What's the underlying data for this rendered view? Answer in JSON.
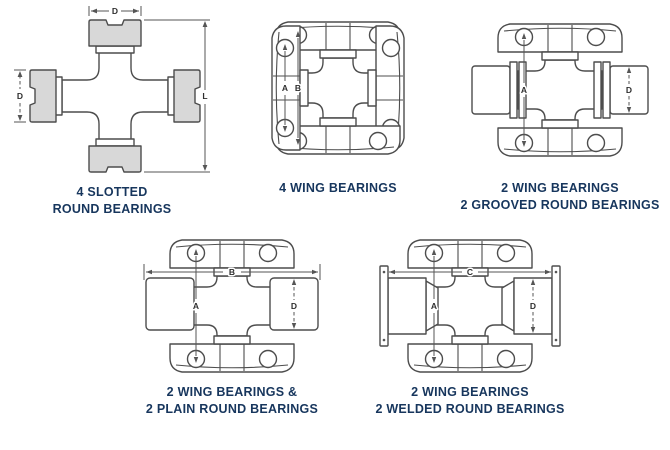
{
  "figures": [
    {
      "id": "4-slotted-round-bearings",
      "caption_line1": "4 SLOTTED",
      "caption_line2": "ROUND BEARINGS",
      "dims": {
        "width": "D",
        "height": "D",
        "length": "L"
      }
    },
    {
      "id": "4-wing-bearings",
      "caption_line1": "4 WING BEARINGS",
      "caption_line2": "",
      "dims": {
        "a": "A",
        "b": "B"
      }
    },
    {
      "id": "2-wing-2-grooved-round-bearings",
      "caption_line1": "2 WING BEARINGS",
      "caption_line2": "2 GROOVED ROUND BEARINGS",
      "dims": {
        "a": "A",
        "d": "D"
      }
    },
    {
      "id": "2-wing-2-plain-round-bearings",
      "caption_line1": "2 WING BEARINGS &",
      "caption_line2": "2 PLAIN ROUND BEARINGS",
      "dims": {
        "b": "B",
        "a": "A",
        "d": "D"
      }
    },
    {
      "id": "2-wing-2-welded-round-bearings",
      "caption_line1": "2 WING BEARINGS",
      "caption_line2": "2 WELDED ROUND BEARINGS",
      "dims": {
        "c": "C",
        "a": "A",
        "d": "D"
      }
    }
  ],
  "colors": {
    "caption_text": "#17365d",
    "outline": "#4d4d4d",
    "dimension_lines": "#555555",
    "bearing_cap_fill": "#d8d8d8",
    "background": "#ffffff"
  }
}
